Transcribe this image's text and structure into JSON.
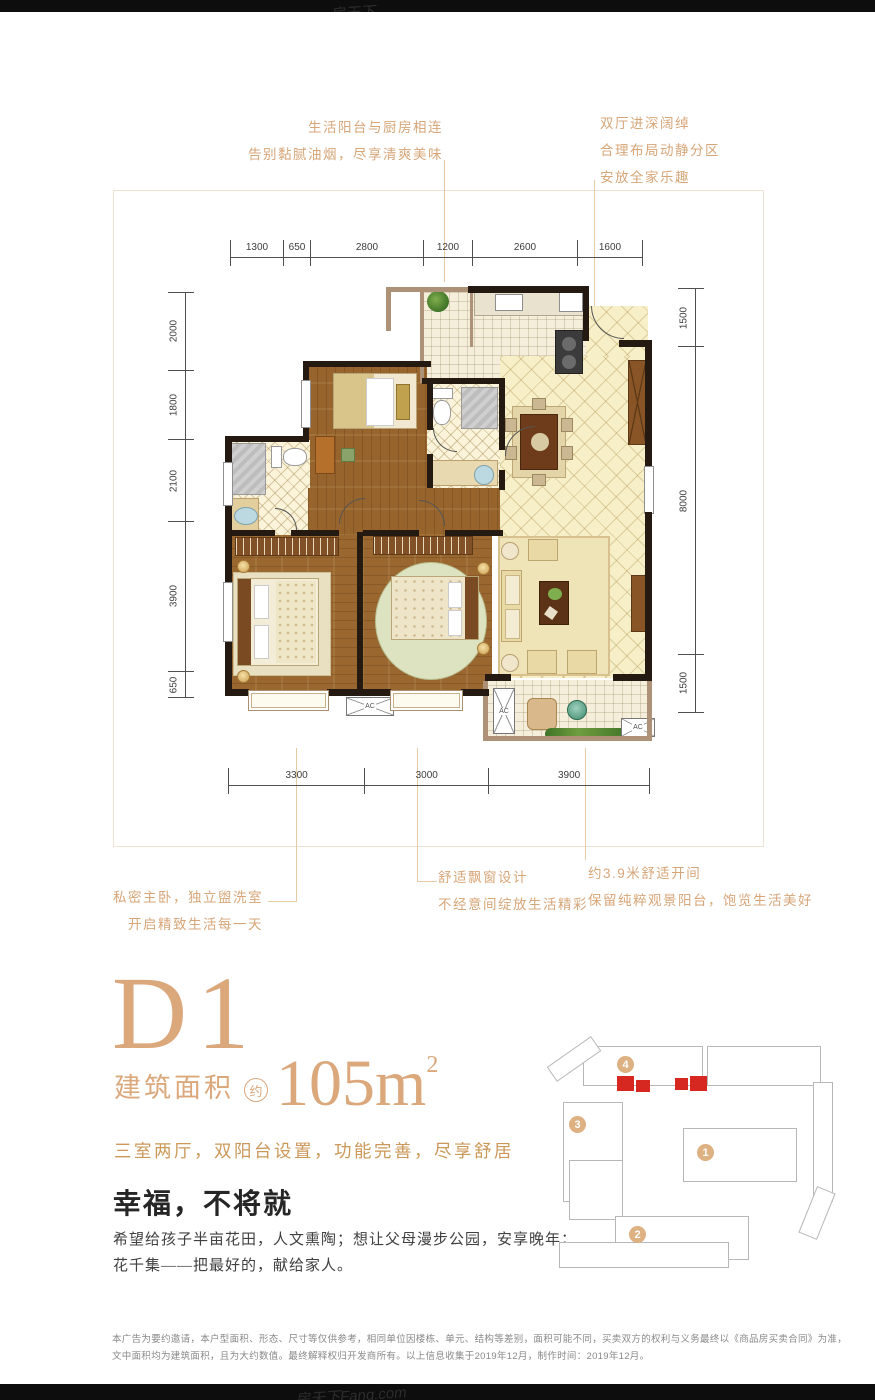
{
  "page": {
    "watermark_top": "房天下",
    "watermark_bottom": "房天下Fang.com"
  },
  "callouts": {
    "top_left": {
      "lines": [
        "生活阳台与厨房相连",
        "告别黏腻油烟，尽享清爽美味"
      ]
    },
    "top_right": {
      "lines": [
        "双厅进深阔绰",
        "合理布局动静分区",
        "安放全家乐趣"
      ]
    },
    "bottom_left": {
      "lines": [
        "私密主卧，独立盥洗室",
        "开启精致生活每一天"
      ]
    },
    "bottom_middle": {
      "lines": [
        "舒适飘窗设计",
        "不经意间绽放生活精彩"
      ]
    },
    "bottom_right": {
      "lines": [
        "约3.9米舒适开间",
        "保留纯粹观景阳台，饱览生活美好"
      ]
    }
  },
  "dimensions": {
    "top": [
      1300,
      650,
      2800,
      1200,
      2600,
      1600
    ],
    "left": [
      2000,
      1800,
      2100,
      3900,
      650
    ],
    "right": [
      1500,
      8000,
      1500
    ],
    "bottom": [
      3300,
      3000,
      3900
    ]
  },
  "floorplan": {
    "ac_label": "AC"
  },
  "unit_info": {
    "unit_name": "D1",
    "area_label": "建筑面积",
    "area_approx": "约",
    "area_value": "105m",
    "area_exponent": "2",
    "tagline": "三室两厅，双阳台设置，功能完善，尽享舒居"
  },
  "slogan": {
    "title": "幸福，不将就",
    "body": [
      "希望给孩子半亩花田，人文熏陶；想让父母漫步公园，安享晚年；",
      "花千集——把最好的，献给家人。"
    ]
  },
  "siteplan": {
    "building_labels": [
      "1",
      "2",
      "3",
      "4"
    ],
    "highlight_color": "#d62821"
  },
  "disclaimer": [
    "本广告为要约邀请，本户型面积、形态、尺寸等仅供参考，相同单位因楼栋、单元、结构等差别，面积可能不同，买卖双方的权利与义务最终以《商品房买卖合同》为准，",
    "文中面积均为建筑面积，且为大约数值。最终解释权归开发商所有。以上信息收集于2019年12月，制作时间：2019年12月。"
  ]
}
